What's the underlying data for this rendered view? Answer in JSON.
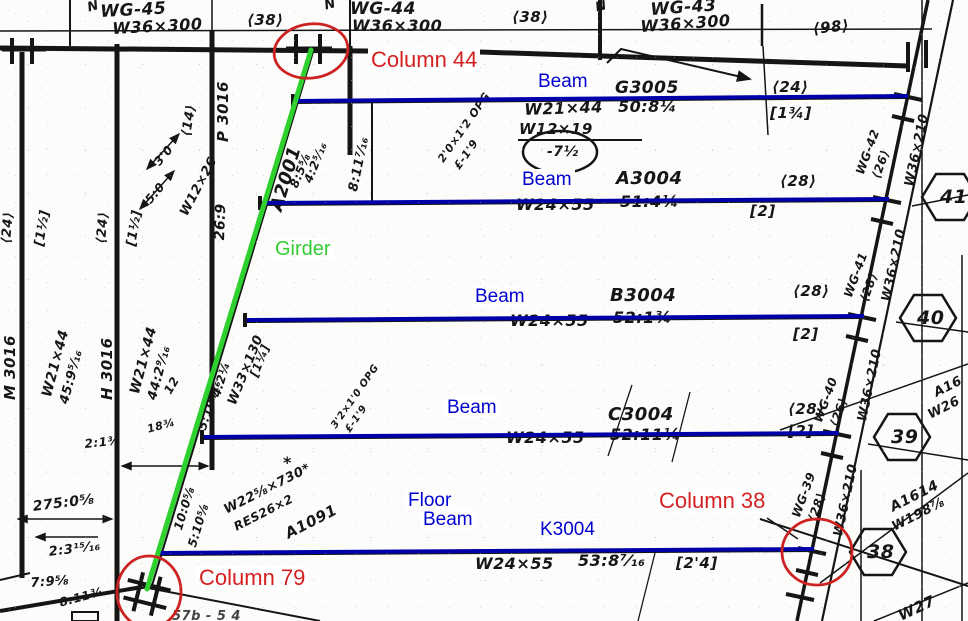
{
  "colors": {
    "beam-blue": "#0000a8",
    "girder-green": "#2fd12f",
    "circle-red": "#cc2222",
    "label-red": "#d42020",
    "label-blue": "#0000d0",
    "label-green": "#33cc33"
  },
  "overlay": {
    "columns": [
      {
        "label": "Column 44"
      },
      {
        "label": "Column 38"
      },
      {
        "label": "Column 79"
      }
    ],
    "beam_labels": [
      "Beam",
      "Beam",
      "Beam",
      "Beam"
    ],
    "floor_beam": {
      "line1": "Floor",
      "line2": "Beam",
      "mark": "K3004"
    },
    "girder_label": "Girder"
  },
  "plan": {
    "revision_mark": "N",
    "top_girders": [
      {
        "mark": "WG-45",
        "size": "W36×300"
      },
      {
        "mark": "WG-44",
        "size": "W36×300"
      },
      {
        "mark": "WG-43",
        "size": "W36×300"
      }
    ],
    "top_stud_counts": [
      "⟨38⟩",
      "⟨38⟩",
      "⟨98⟩"
    ],
    "beams": [
      {
        "mark": "G3005",
        "size": "W21×44",
        "length": "50:8¼",
        "studs": "⟨24⟩",
        "camber": "[1¾]"
      },
      {
        "mark": "A3004",
        "size": "W24×55",
        "length": "51:4¼",
        "studs": "⟨28⟩",
        "camber": "[2]"
      },
      {
        "mark": "B3004",
        "size": "W24×55",
        "length": "52:1¾",
        "studs": "⟨28⟩",
        "camber": "[2]"
      },
      {
        "mark": "C3004",
        "size": "W24×55",
        "length": "52:11¼",
        "studs": "⟨28⟩",
        "camber": "[2]"
      },
      {
        "mark": "K3004",
        "size": "W24×55",
        "length": "53:8⁷⁄₁₆",
        "camber": "[2'4]"
      }
    ],
    "infill_beam": {
      "size": "W12×19",
      "camber_note": "-7½"
    },
    "left_beams": [
      {
        "mark": "M 3016",
        "size": "W21×44",
        "length": "45:9⁵⁄₁₆",
        "studs": "⟨24⟩",
        "camber": "[1½]"
      },
      {
        "mark": "H 3016",
        "size": "W21×44",
        "length": "44:2⁹⁄₁₆",
        "studs": "⟨24⟩",
        "camber": "[1½]"
      },
      {
        "mark": "P 3016",
        "size": "W12×26",
        "length": "26:9",
        "studs": "⟨14⟩"
      }
    ],
    "girder_marks": {
      "a2001": "A2001",
      "a1091": "A1091",
      "w22": "W22⅝×730*",
      "res": "RES26×2",
      "w33": "W33×130",
      "w33_camber": "[1¼]",
      "star": "*"
    },
    "openings": [
      {
        "size": "2'0×1'2 OPG",
        "cl": "£-1'9"
      },
      {
        "size": "3'2×1'0 OPG",
        "cl": "£-1'9"
      }
    ],
    "dims": {
      "d1": "8:11⁷⁄₁₆",
      "d2": "3'0",
      "d3": "5:0",
      "d4": "8:5⅝",
      "d5": "4:2⁵⁄₁₆",
      "d6": "5:10¹⁄₁₆",
      "d7": "4:2¼",
      "d8": "10:0⅝",
      "d9": "5:10⅝",
      "d10": "275:0⅝",
      "d11": "2:3¹⁵⁄₁₆",
      "d12": "7:9⅝",
      "d13": "8:11¾",
      "d14": "2:1⅜",
      "d15": "12",
      "d16": "18¾"
    },
    "right_grid": {
      "bubbles": [
        "41",
        "40",
        "39",
        "38"
      ],
      "column_size": "W36×210",
      "girders": [
        {
          "mark": "WG-42",
          "studs": "⟨26⟩"
        },
        {
          "mark": "WG-41",
          "studs": "⟨28⟩"
        },
        {
          "mark": "WG-40",
          "studs": "⟨26⟩"
        },
        {
          "mark": "WG-39",
          "studs": "⟨28⟩"
        }
      ],
      "corner_notes": [
        "A1614",
        "W198⅞",
        "A16",
        "W26",
        "W27"
      ]
    },
    "clipped_text": "57b - 5 4"
  }
}
